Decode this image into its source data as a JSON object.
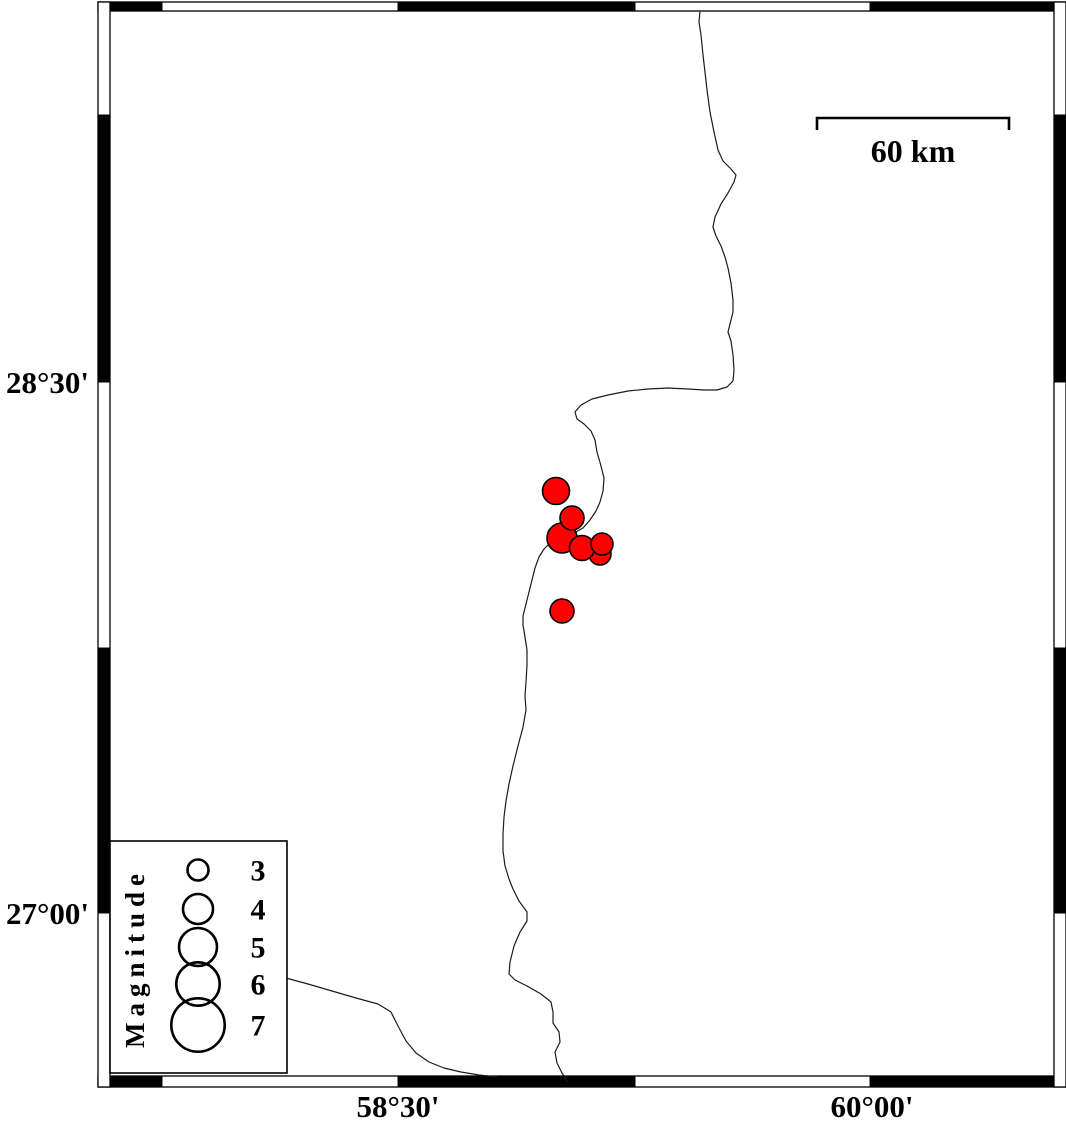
{
  "figure": {
    "type": "seismicity-map",
    "colors": {
      "background": "#ffffff",
      "frame": "#000000",
      "coastline": "#1b1b1b",
      "quake_fill": "#ff0000",
      "quake_stroke": "#000000"
    },
    "frame": {
      "bands": {
        "top": {
          "x": 98,
          "y": 2,
          "w": 968,
          "h": 9
        },
        "bottom": {
          "x": 98,
          "y": 1076,
          "w": 968,
          "h": 11
        },
        "left": {
          "x": 98,
          "y": 2,
          "w": 12,
          "h": 1085
        },
        "right": {
          "x": 1054,
          "y": 2,
          "w": 12,
          "h": 1085
        }
      },
      "black_segments": {
        "top": [
          [
            110,
            162
          ],
          [
            398,
            635
          ],
          [
            870,
            1054
          ]
        ],
        "bottom": [
          [
            110,
            162
          ],
          [
            398,
            635
          ],
          [
            870,
            1053
          ]
        ],
        "left": [
          [
            115,
            382
          ],
          [
            648,
            913
          ]
        ],
        "right": [
          [
            115,
            382
          ],
          [
            648,
            913
          ]
        ]
      }
    },
    "axes": {
      "lat_labels": [
        {
          "text": "28°30'",
          "x": 89,
          "y": 393
        },
        {
          "text": "27°00'",
          "x": 89,
          "y": 924
        }
      ],
      "lon_labels": [
        {
          "text": "58°30'",
          "x": 398,
          "y": 1117
        },
        {
          "text": "60°00'",
          "x": 872,
          "y": 1117
        }
      ]
    },
    "scale_bar": {
      "label": "60 km",
      "x1": 817,
      "x2": 1009,
      "y": 118,
      "drop": 12,
      "label_x": 913,
      "label_y": 162
    },
    "legend": {
      "title": "Magnitude",
      "box": {
        "x": 110,
        "y": 841,
        "w": 177,
        "h": 232
      },
      "title_pos": {
        "x": 144,
        "y": 958
      },
      "circle_cx": 198,
      "value_x": 258,
      "entries": [
        {
          "value": "3",
          "cy": 870,
          "r": 10.5
        },
        {
          "value": "4",
          "cy": 909,
          "r": 15
        },
        {
          "value": "5",
          "cy": 947,
          "r": 19
        },
        {
          "value": "6",
          "cy": 984,
          "r": 21.7
        },
        {
          "value": "7",
          "cy": 1025,
          "r": 26.7
        }
      ]
    },
    "earthquakes": [
      {
        "x": 600,
        "y": 554,
        "r": 11
      },
      {
        "x": 562,
        "y": 538,
        "r": 15
      },
      {
        "x": 582,
        "y": 548,
        "r": 12.5
      },
      {
        "x": 602,
        "y": 544,
        "r": 11
      },
      {
        "x": 572,
        "y": 518,
        "r": 12
      },
      {
        "x": 556,
        "y": 491,
        "r": 13.5
      },
      {
        "x": 562,
        "y": 611,
        "r": 12
      }
    ],
    "coastline": {
      "main": [
        [
          700,
          11
        ],
        [
          699,
          22
        ],
        [
          701,
          35
        ],
        [
          703,
          55
        ],
        [
          705,
          72
        ],
        [
          707,
          90
        ],
        [
          710,
          112
        ],
        [
          714,
          132
        ],
        [
          718,
          150
        ],
        [
          723,
          161
        ],
        [
          731,
          169
        ],
        [
          736,
          175
        ],
        [
          734,
          182
        ],
        [
          728,
          193
        ],
        [
          721,
          204
        ],
        [
          715,
          217
        ],
        [
          713,
          227
        ],
        [
          716,
          236
        ],
        [
          721,
          246
        ],
        [
          725,
          257
        ],
        [
          728,
          268
        ],
        [
          731,
          283
        ],
        [
          733,
          300
        ],
        [
          733,
          312
        ],
        [
          730,
          324
        ],
        [
          728,
          332
        ],
        [
          731,
          341
        ],
        [
          733,
          355
        ],
        [
          734,
          370
        ],
        [
          733,
          381
        ],
        [
          727,
          387
        ],
        [
          717,
          390
        ],
        [
          704,
          390
        ],
        [
          688,
          389
        ],
        [
          668,
          388
        ],
        [
          648,
          389
        ],
        [
          628,
          391
        ],
        [
          608,
          395
        ],
        [
          592,
          399
        ],
        [
          581,
          405
        ],
        [
          575,
          412
        ],
        [
          577,
          419
        ],
        [
          584,
          424
        ],
        [
          591,
          431
        ],
        [
          595,
          440
        ],
        [
          597,
          452
        ],
        [
          601,
          466
        ],
        [
          604,
          478
        ],
        [
          603,
          491
        ],
        [
          600,
          502
        ],
        [
          596,
          511
        ],
        [
          590,
          520
        ],
        [
          583,
          528
        ],
        [
          574,
          533
        ],
        [
          562,
          536
        ],
        [
          551,
          542
        ],
        [
          544,
          549
        ],
        [
          539,
          557
        ],
        [
          535,
          568
        ],
        [
          532,
          580
        ],
        [
          529,
          592
        ],
        [
          526,
          604
        ],
        [
          523,
          616
        ],
        [
          523,
          625
        ],
        [
          525,
          637
        ],
        [
          527,
          650
        ],
        [
          527,
          665
        ],
        [
          526,
          682
        ],
        [
          525,
          696
        ],
        [
          526,
          710
        ],
        [
          523,
          727
        ],
        [
          518,
          746
        ],
        [
          513,
          766
        ],
        [
          509,
          784
        ],
        [
          506,
          801
        ],
        [
          504,
          817
        ],
        [
          503,
          834
        ],
        [
          503,
          851
        ],
        [
          505,
          866
        ],
        [
          509,
          879
        ],
        [
          513,
          889
        ],
        [
          519,
          901
        ],
        [
          527,
          912
        ],
        [
          527,
          921
        ],
        [
          520,
          932
        ],
        [
          514,
          946
        ],
        [
          510,
          962
        ],
        [
          509,
          974
        ],
        [
          515,
          980
        ],
        [
          527,
          986
        ],
        [
          541,
          994
        ],
        [
          551,
          1002
        ],
        [
          553,
          1012
        ],
        [
          553,
          1023
        ],
        [
          559,
          1032
        ],
        [
          560,
          1042
        ],
        [
          555,
          1052
        ],
        [
          557,
          1063
        ],
        [
          562,
          1073
        ],
        [
          567,
          1081
        ]
      ],
      "branch": [
        [
          286,
          978
        ],
        [
          308,
          984
        ],
        [
          332,
          991
        ],
        [
          356,
          998
        ],
        [
          378,
          1004
        ],
        [
          391,
          1012
        ],
        [
          398,
          1026
        ],
        [
          406,
          1041
        ],
        [
          416,
          1053
        ],
        [
          429,
          1062
        ],
        [
          444,
          1068
        ],
        [
          461,
          1072
        ],
        [
          479,
          1075
        ],
        [
          497,
          1077
        ]
      ]
    }
  }
}
